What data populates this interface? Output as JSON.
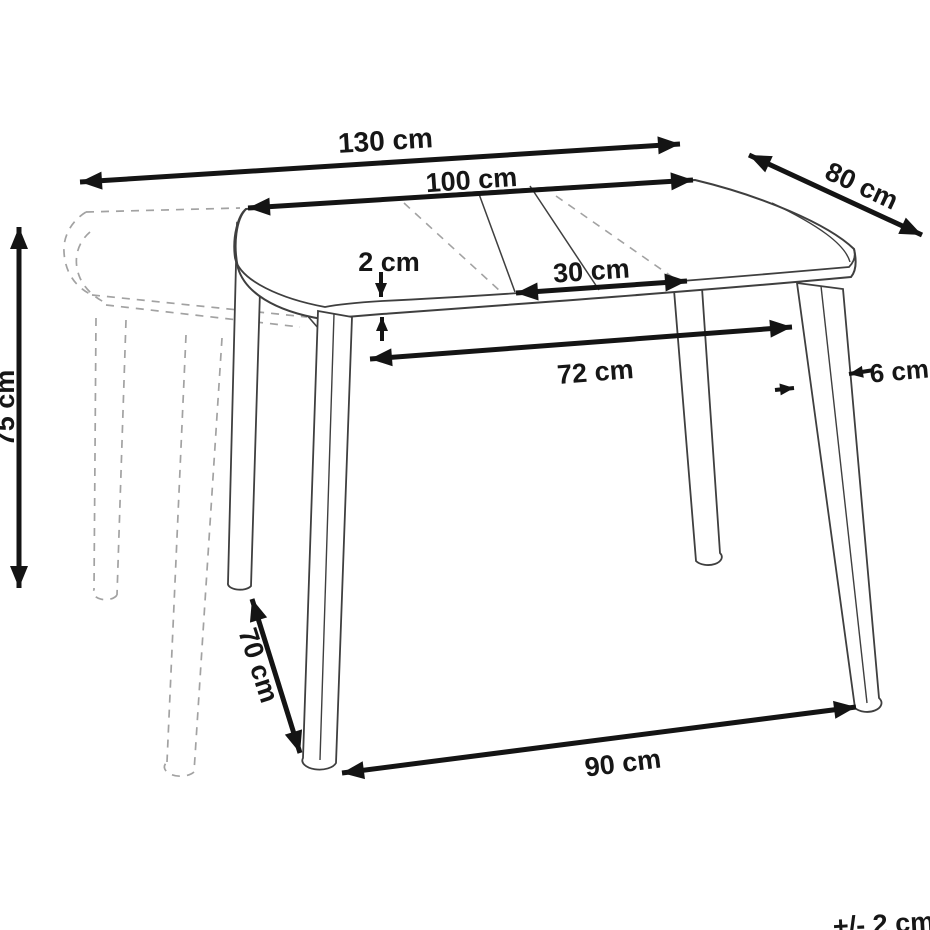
{
  "labels": {
    "dim_130": "130 cm",
    "dim_100": "100 cm",
    "dim_80": "80 cm",
    "dim_2": "2 cm",
    "dim_30": "30 cm",
    "dim_72": "72 cm",
    "dim_6": "6 cm",
    "dim_75": "75 cm",
    "dim_70": "70 cm",
    "dim_90": "90 cm",
    "tolerance": "+/- 2 cm"
  },
  "colors": {
    "table_line": "#3f3f3f",
    "ghost_line": "#a2a2a2",
    "dimension": "#141414",
    "background": "#ffffff"
  }
}
